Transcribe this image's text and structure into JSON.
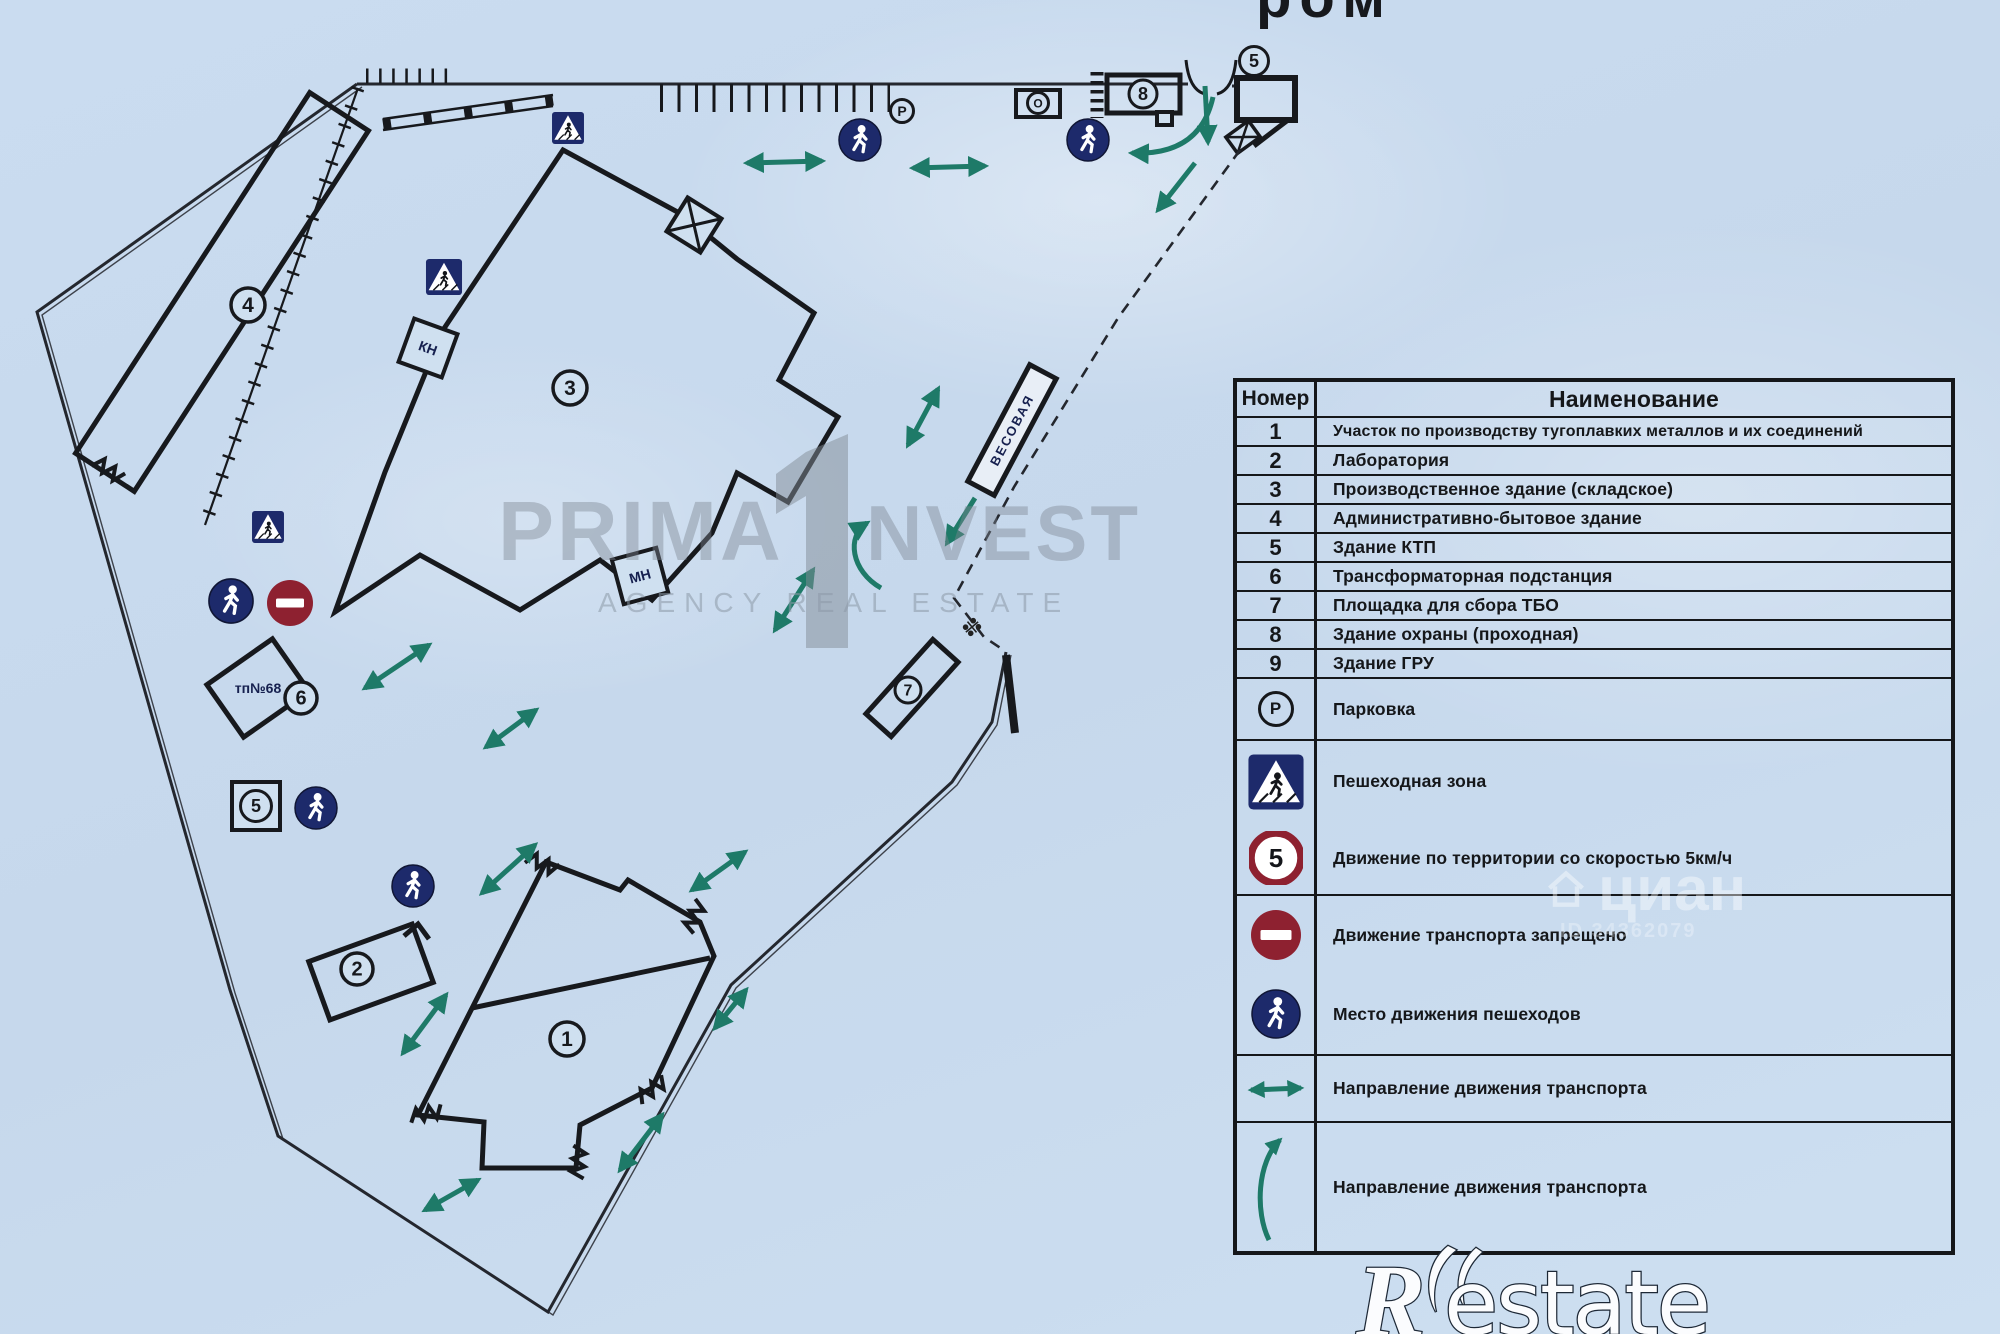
{
  "title_fragment": "ром",
  "map": {
    "building_labels": {
      "b1": "1",
      "b2": "2",
      "b3": "3",
      "b4": "4",
      "b5": "5",
      "b6": "6",
      "b7": "7",
      "b8": "8"
    },
    "sign_labels": {
      "parking": "Р",
      "gate_o": "О",
      "speed_top": "5",
      "square5": "5"
    },
    "box_labels": {
      "kn": "КН",
      "mn": "МН",
      "tp68": "тп№68",
      "vesovaya": "ВЕСОВАЯ"
    }
  },
  "legend": {
    "header": {
      "number": "Номер",
      "name": "Наименование"
    },
    "rows": [
      {
        "num": "1",
        "name": "Участок по производству тугоплавких металлов и их соединений"
      },
      {
        "num": "2",
        "name": "Лаборатория"
      },
      {
        "num": "3",
        "name": "Производственное здание (складское)"
      },
      {
        "num": "4",
        "name": "Административно-бытовое здание"
      },
      {
        "num": "5",
        "name": "Здание КТП"
      },
      {
        "num": "6",
        "name": "Трансформаторная подстанция"
      },
      {
        "num": "7",
        "name": "Площадка для сбора ТБО"
      },
      {
        "num": "8",
        "name": "Здание охраны (проходная)"
      },
      {
        "num": "9",
        "name": "Здание ГРУ"
      }
    ],
    "parking_row": {
      "symbol": "Р",
      "name": "Парковка"
    },
    "sign_rows": [
      {
        "icon": "pedestrian-crossing-sign",
        "name": "Пешеходная зона"
      },
      {
        "icon": "speed-limit-5-sign",
        "name": "Движение по территории со скоростью 5км/ч"
      },
      {
        "icon": "no-entry-sign",
        "name": "Движение транспорта запрещено"
      },
      {
        "icon": "pedestrian-zone-sign",
        "name": "Место движения пешеходов"
      },
      {
        "icon": "transport-direction-arrow",
        "name": "Направление движения транспорта"
      },
      {
        "icon": "transport-direction-curved-arrow",
        "name": "Направление движения транспорта"
      }
    ]
  },
  "watermarks": {
    "prima_left": "PRIMA",
    "prima_right": "NVEST",
    "agency": "AGENCY REAL ESTATE",
    "cian": "циан",
    "cian_id": "ID 34362079",
    "restate_r": "R",
    "restate_tail": "estate"
  },
  "colors": {
    "background": "#c9daee",
    "line": "#17191d",
    "sign_blue": "#1d2a6b",
    "sign_red": "#8e2130",
    "arrow_green": "#1e7a68"
  }
}
